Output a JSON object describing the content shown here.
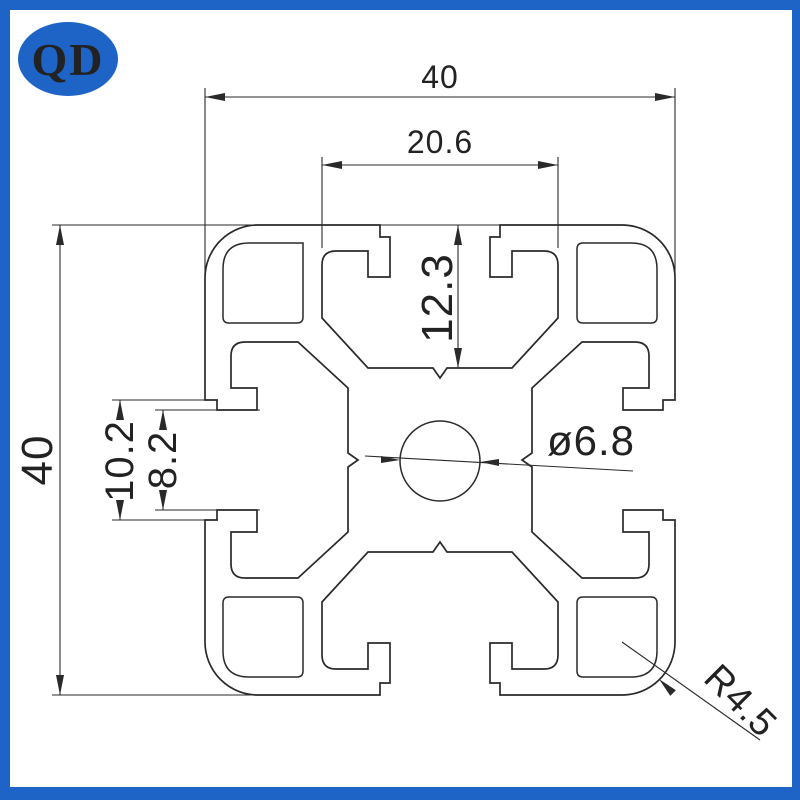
{
  "logo": {
    "text": "QD"
  },
  "colors": {
    "frame_blue": "#1E64C6",
    "line": "#2a2a2a",
    "background": "#ffffff",
    "logo_text": "#ffffff"
  },
  "drawing": {
    "type": "aluminium-profile-cross-section",
    "dimensions": {
      "overall_width": "40",
      "overall_height": "40",
      "slot_cavity_width": "20.6",
      "slot_depth": "12.3",
      "slot_opening_outer": "10.2",
      "slot_opening_inner": "8.2",
      "center_hole_diameter": "ø6.8",
      "corner_radius": "R4.5"
    }
  }
}
